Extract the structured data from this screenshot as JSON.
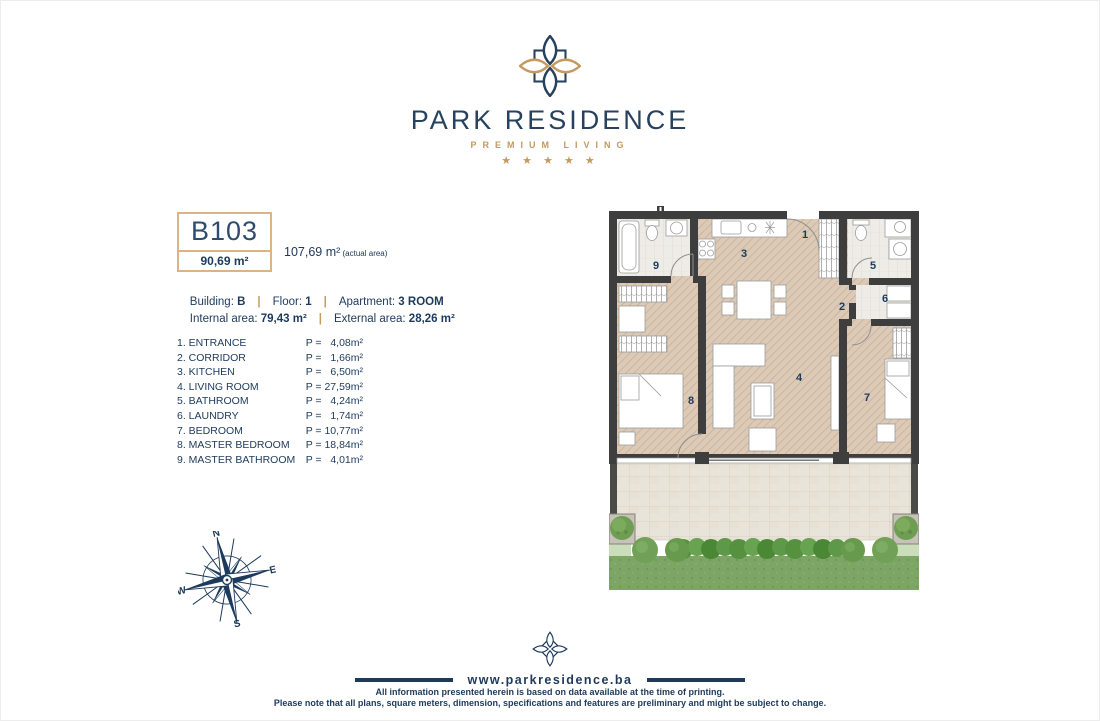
{
  "header": {
    "brand": "PARK RESIDENCE",
    "tagline": "PREMIUM LIVING",
    "stars": "★ ★ ★ ★ ★"
  },
  "unit": {
    "code": "B103",
    "area": "90,69 m²",
    "actual_area": "107,69 m²",
    "actual_note": " (actual area)"
  },
  "details": {
    "building_label": "Building: ",
    "building": "B",
    "floor_label": "Floor: ",
    "floor": "1",
    "apartment_label": "Apartment: ",
    "apartment": "3 ROOM",
    "internal_label": "Internal area: ",
    "internal": "79,43 m²",
    "external_label": "External area: ",
    "external": "28,26 m²",
    "separator": "|"
  },
  "rooms": [
    {
      "name": "1. ENTRANCE",
      "area": "P =   4,08m²"
    },
    {
      "name": "2. CORRIDOR",
      "area": "P =   1,66m²"
    },
    {
      "name": "3. KITCHEN",
      "area": "P =   6,50m²"
    },
    {
      "name": "4. LIVING ROOM",
      "area": "P = 27,59m²"
    },
    {
      "name": "5. BATHROOM",
      "area": "P =   4,24m²"
    },
    {
      "name": "6. LAUNDRY",
      "area": "P =   1,74m²"
    },
    {
      "name": "7. BEDROOM",
      "area": "P = 10,77m²"
    },
    {
      "name": "8. MASTER BEDROOM",
      "area": "P = 18,84m²"
    },
    {
      "name": "9. MASTER BATHROOM",
      "area": "P =   4,01m²"
    }
  ],
  "plan_labels": [
    "1",
    "2",
    "3",
    "4",
    "5",
    "6",
    "7",
    "8",
    "9"
  ],
  "compass": {
    "n": "N",
    "e": "E",
    "s": "S",
    "w": "W"
  },
  "footer": {
    "website": "www.parkresidence.ba",
    "line1": "All information presented herein is based on data available at the time of printing.",
    "line2": "Please note that all plans, square meters, dimension, specifications and features are preliminary and might be subject to change."
  },
  "colors": {
    "navy": "#1d3a5c",
    "gold": "#c49a5e",
    "box_border": "#ddb284",
    "wall": "#3e3e3e",
    "floor": "#dccab6",
    "bath_floor": "#eeece7",
    "terrace": "#e9e4d9",
    "grass": "#7da566",
    "hedge": "#55913f"
  }
}
